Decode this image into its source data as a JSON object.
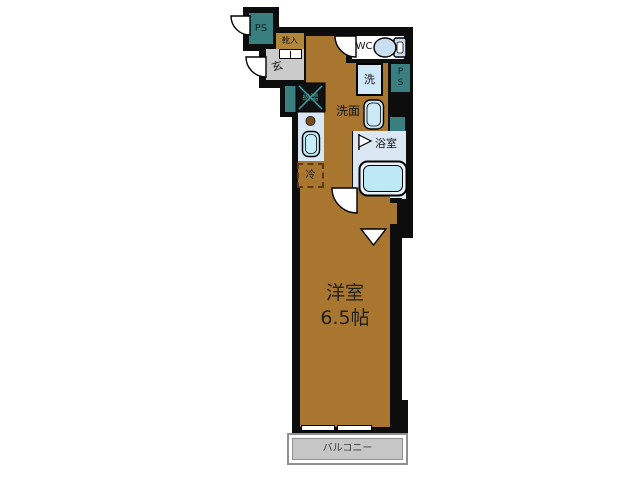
{
  "plan_title": "1K floor plan",
  "labels": {
    "ps_top": "PS",
    "shoe_box": "靴入",
    "entrance": "玄",
    "wc": "WC",
    "washer": "洗",
    "ps_right_line1": "P",
    "ps_right_line2": "S",
    "washroom": "洗面",
    "water_heater": "給湯",
    "bathroom": "浴室",
    "refrigerator": "冷",
    "closet": "CL",
    "main_room_name": "洋室",
    "main_room_size": "6.5帖",
    "balcony": "バルコニー"
  },
  "colors": {
    "wall": "#0d0d0d",
    "room_brown": "#a8762e",
    "shoe_box_tan": "#b3873b",
    "teal": "#3a7f7f",
    "heater_teal": "#3fa0a0",
    "genkan_gray": "#cbcbcb",
    "balcony_gray": "#c6c6c6",
    "counter_blue": "#d7e7f5",
    "sink_blue": "#c6edf8",
    "bath_floor_blue": "#dbe7f3",
    "tub_blue": "#bce9f4",
    "toilet_blue": "#c9def0"
  }
}
